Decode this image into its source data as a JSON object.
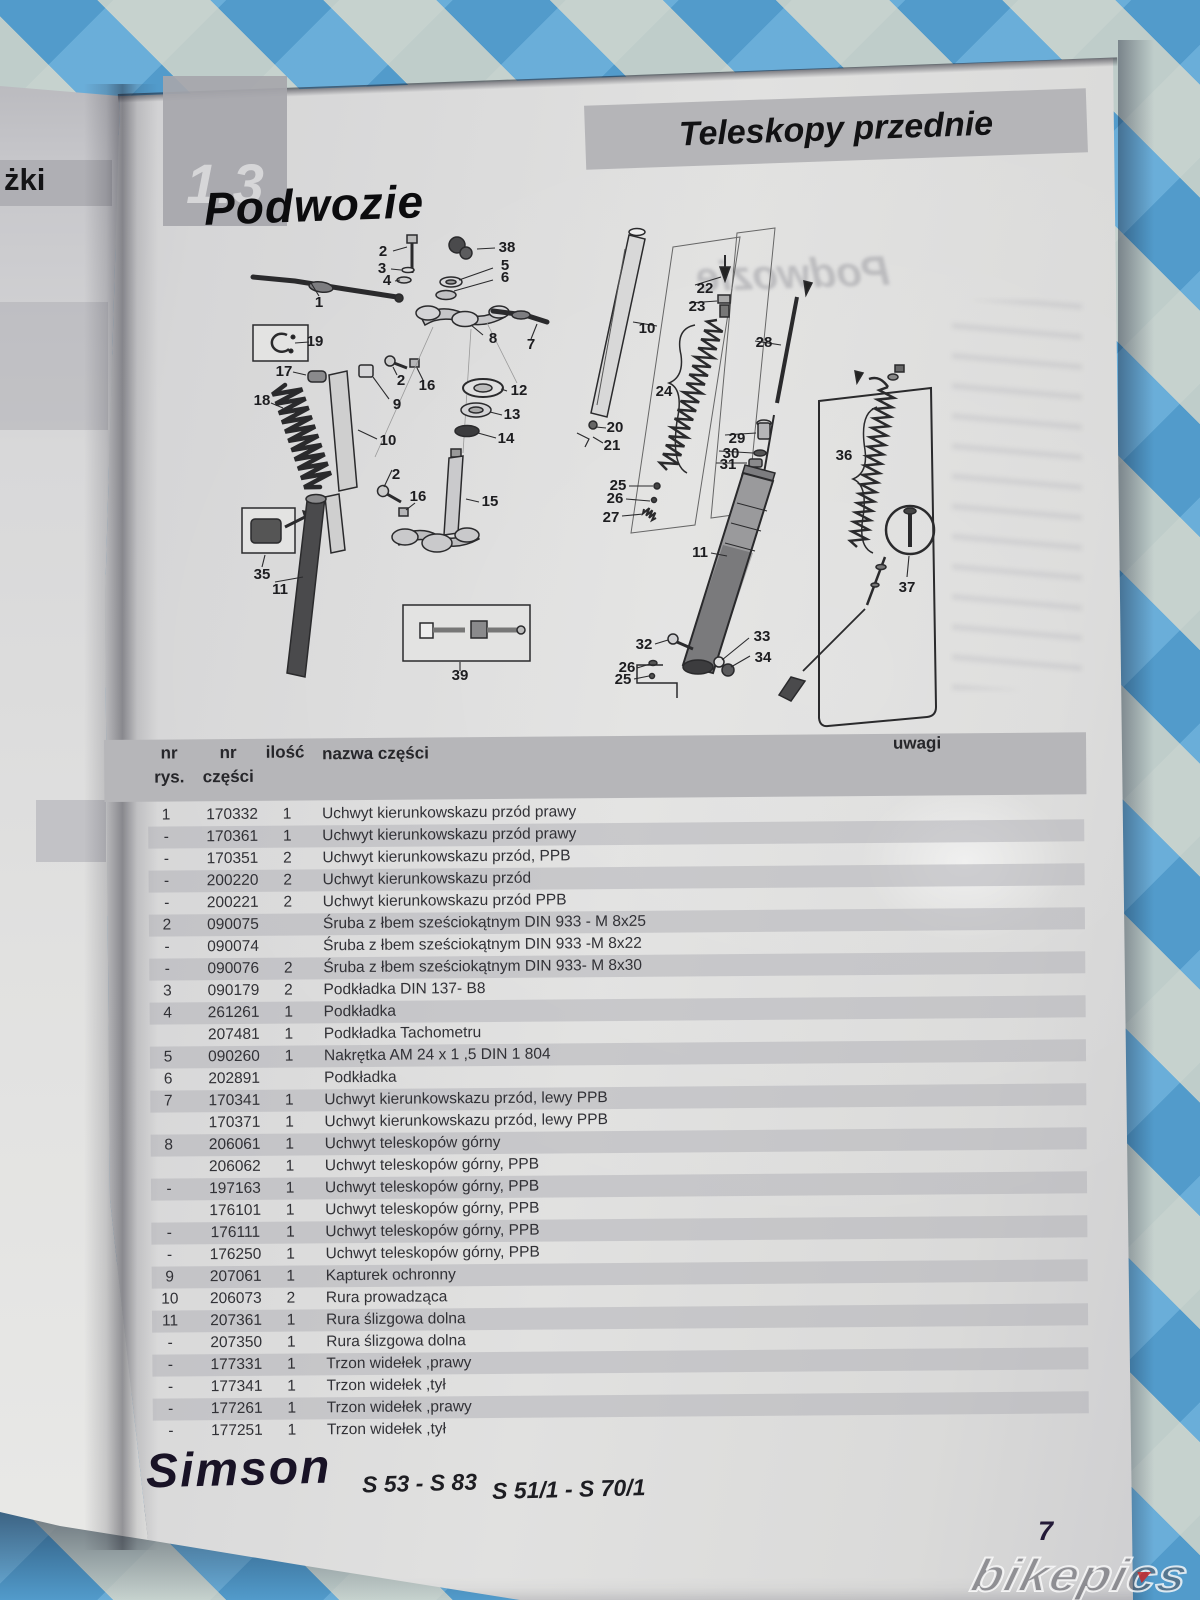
{
  "page": {
    "section_number": "1.3",
    "section_title": "Podwozie",
    "header_banner": "Teleskopy przednie",
    "ghost_title": "Podwozie",
    "left_page_fragment": "żki",
    "page_number": "7",
    "watermark": "bikepics"
  },
  "footer": {
    "brand": "Simson",
    "models_left": "S 53 - S 83",
    "models_right": "S 51/1 - S 70/1"
  },
  "parts_table": {
    "header": {
      "col_rys_line1": "nr",
      "col_rys_line2": "rys.",
      "col_part_line1": "nr",
      "col_part_line2": "części",
      "col_qty": "ilość",
      "col_name": "nazwa części",
      "col_notes": "uwagi"
    },
    "rows": [
      {
        "rys": "1",
        "part": "170332",
        "qty": "1",
        "name": "Uchwyt kierunkowskazu przód prawy"
      },
      {
        "rys": "-",
        "part": "170361",
        "qty": "1",
        "name": "Uchwyt kierunkowskazu przód prawy"
      },
      {
        "rys": "-",
        "part": "170351",
        "qty": "2",
        "name": "Uchwyt kierunkowskazu przód, PPB"
      },
      {
        "rys": "-",
        "part": "200220",
        "qty": "2",
        "name": "Uchwyt kierunkowskazu przód"
      },
      {
        "rys": "-",
        "part": "200221",
        "qty": "2",
        "name": "Uchwyt kierunkowskazu przód PPB"
      },
      {
        "rys": "2",
        "part": "090075",
        "qty": "",
        "name": "Śruba z łbem sześciokątnym DIN 933 - M 8x25"
      },
      {
        "rys": "-",
        "part": "090074",
        "qty": "",
        "name": "Śruba z łbem sześciokątnym DIN 933 -M 8x22"
      },
      {
        "rys": "-",
        "part": "090076",
        "qty": "2",
        "name": "Śruba z łbem sześciokątnym DIN 933- M 8x30"
      },
      {
        "rys": "3",
        "part": "090179",
        "qty": "2",
        "name": "Podkładka DIN 137- B8"
      },
      {
        "rys": "4",
        "part": "261261",
        "qty": "1",
        "name": "Podkładka"
      },
      {
        "rys": "",
        "part": "207481",
        "qty": "1",
        "name": "Podkładka Tachometru"
      },
      {
        "rys": "5",
        "part": "090260",
        "qty": "1",
        "name": "Nakrętka AM 24 x 1 ,5 DIN 1 804"
      },
      {
        "rys": "6",
        "part": "202891",
        "qty": "",
        "name": "Podkładka"
      },
      {
        "rys": "7",
        "part": "170341",
        "qty": "1",
        "name": "Uchwyt kierunkowskazu przód, lewy PPB"
      },
      {
        "rys": "",
        "part": "170371",
        "qty": "1",
        "name": "Uchwyt kierunkowskazu przód, lewy PPB"
      },
      {
        "rys": "8",
        "part": "206061",
        "qty": "1",
        "name": "Uchwyt teleskopów górny"
      },
      {
        "rys": "",
        "part": "206062",
        "qty": "1",
        "name": "Uchwyt teleskopów górny, PPB"
      },
      {
        "rys": "-",
        "part": "197163",
        "qty": "1",
        "name": "Uchwyt teleskopów górny, PPB"
      },
      {
        "rys": "",
        "part": "176101",
        "qty": "1",
        "name": "Uchwyt teleskopów górny, PPB"
      },
      {
        "rys": "-",
        "part": "176111",
        "qty": "1",
        "name": "Uchwyt teleskopów górny, PPB"
      },
      {
        "rys": "-",
        "part": "176250",
        "qty": "1",
        "name": "Uchwyt teleskopów górny, PPB"
      },
      {
        "rys": "9",
        "part": "207061",
        "qty": "1",
        "name": "Kapturek ochronny"
      },
      {
        "rys": "10",
        "part": "206073",
        "qty": "2",
        "name": "Rura prowadząca"
      },
      {
        "rys": "11",
        "part": "207361",
        "qty": "1",
        "name": "Rura ślizgowa dolna"
      },
      {
        "rys": "-",
        "part": "207350",
        "qty": "1",
        "name": "Rura ślizgowa dolna"
      },
      {
        "rys": "-",
        "part": "177331",
        "qty": "1",
        "name": "Trzon widełek ,prawy"
      },
      {
        "rys": "-",
        "part": "177341",
        "qty": "1",
        "name": "Trzon widełek ,tył"
      },
      {
        "rys": "-",
        "part": "177261",
        "qty": "1",
        "name": "Trzon widełek ,prawy"
      },
      {
        "rys": "-",
        "part": "177251",
        "qty": "1",
        "name": "Trzon widełek ,tył"
      }
    ]
  },
  "diagram": {
    "callouts": [
      {
        "n": "1",
        "x": 94,
        "y": 78
      },
      {
        "n": "2",
        "x": 158,
        "y": 27
      },
      {
        "n": "3",
        "x": 157,
        "y": 44
      },
      {
        "n": "4",
        "x": 162,
        "y": 56
      },
      {
        "n": "38",
        "x": 282,
        "y": 23
      },
      {
        "n": "5",
        "x": 280,
        "y": 41
      },
      {
        "n": "6",
        "x": 280,
        "y": 53
      },
      {
        "n": "8",
        "x": 268,
        "y": 114
      },
      {
        "n": "7",
        "x": 306,
        "y": 120
      },
      {
        "n": "19",
        "x": 90,
        "y": 117
      },
      {
        "n": "17",
        "x": 59,
        "y": 147
      },
      {
        "n": "18",
        "x": 37,
        "y": 176
      },
      {
        "n": "2",
        "x": 176,
        "y": 156
      },
      {
        "n": "16",
        "x": 202,
        "y": 161
      },
      {
        "n": "9",
        "x": 172,
        "y": 180
      },
      {
        "n": "12",
        "x": 294,
        "y": 166
      },
      {
        "n": "13",
        "x": 287,
        "y": 190
      },
      {
        "n": "14",
        "x": 281,
        "y": 214
      },
      {
        "n": "10",
        "x": 163,
        "y": 216
      },
      {
        "n": "2",
        "x": 171,
        "y": 250
      },
      {
        "n": "16",
        "x": 193,
        "y": 272
      },
      {
        "n": "15",
        "x": 265,
        "y": 277
      },
      {
        "n": "35",
        "x": 37,
        "y": 350
      },
      {
        "n": "11",
        "x": 55,
        "y": 365
      },
      {
        "n": "39",
        "x": 235,
        "y": 451
      },
      {
        "n": "10",
        "x": 422,
        "y": 104
      },
      {
        "n": "22",
        "x": 480,
        "y": 64
      },
      {
        "n": "23",
        "x": 472,
        "y": 82
      },
      {
        "n": "24",
        "x": 439,
        "y": 167
      },
      {
        "n": "20",
        "x": 390,
        "y": 203
      },
      {
        "n": "21",
        "x": 387,
        "y": 221
      },
      {
        "n": "28",
        "x": 539,
        "y": 118
      },
      {
        "n": "29",
        "x": 512,
        "y": 214
      },
      {
        "n": "30",
        "x": 506,
        "y": 229
      },
      {
        "n": "31",
        "x": 503,
        "y": 240
      },
      {
        "n": "25",
        "x": 393,
        "y": 261
      },
      {
        "n": "26",
        "x": 390,
        "y": 274
      },
      {
        "n": "27",
        "x": 386,
        "y": 293
      },
      {
        "n": "11",
        "x": 475,
        "y": 328
      },
      {
        "n": "32",
        "x": 419,
        "y": 420
      },
      {
        "n": "33",
        "x": 537,
        "y": 412
      },
      {
        "n": "34",
        "x": 538,
        "y": 433
      },
      {
        "n": "26",
        "x": 402,
        "y": 443
      },
      {
        "n": "25",
        "x": 398,
        "y": 455
      },
      {
        "n": "36",
        "x": 619,
        "y": 231
      },
      {
        "n": "37",
        "x": 682,
        "y": 363
      }
    ]
  },
  "colors": {
    "tablecloth_blue": "#4795c8",
    "tablecloth_light_blue": "#80bde3",
    "tablecloth_cream": "#e9e0ca",
    "page_gray": "#dadad9",
    "row_stripe": "#c6c6c9",
    "header_band": "#b6b6b9",
    "banner_gray": "#b5b5b8",
    "text_dark": "#313136"
  }
}
